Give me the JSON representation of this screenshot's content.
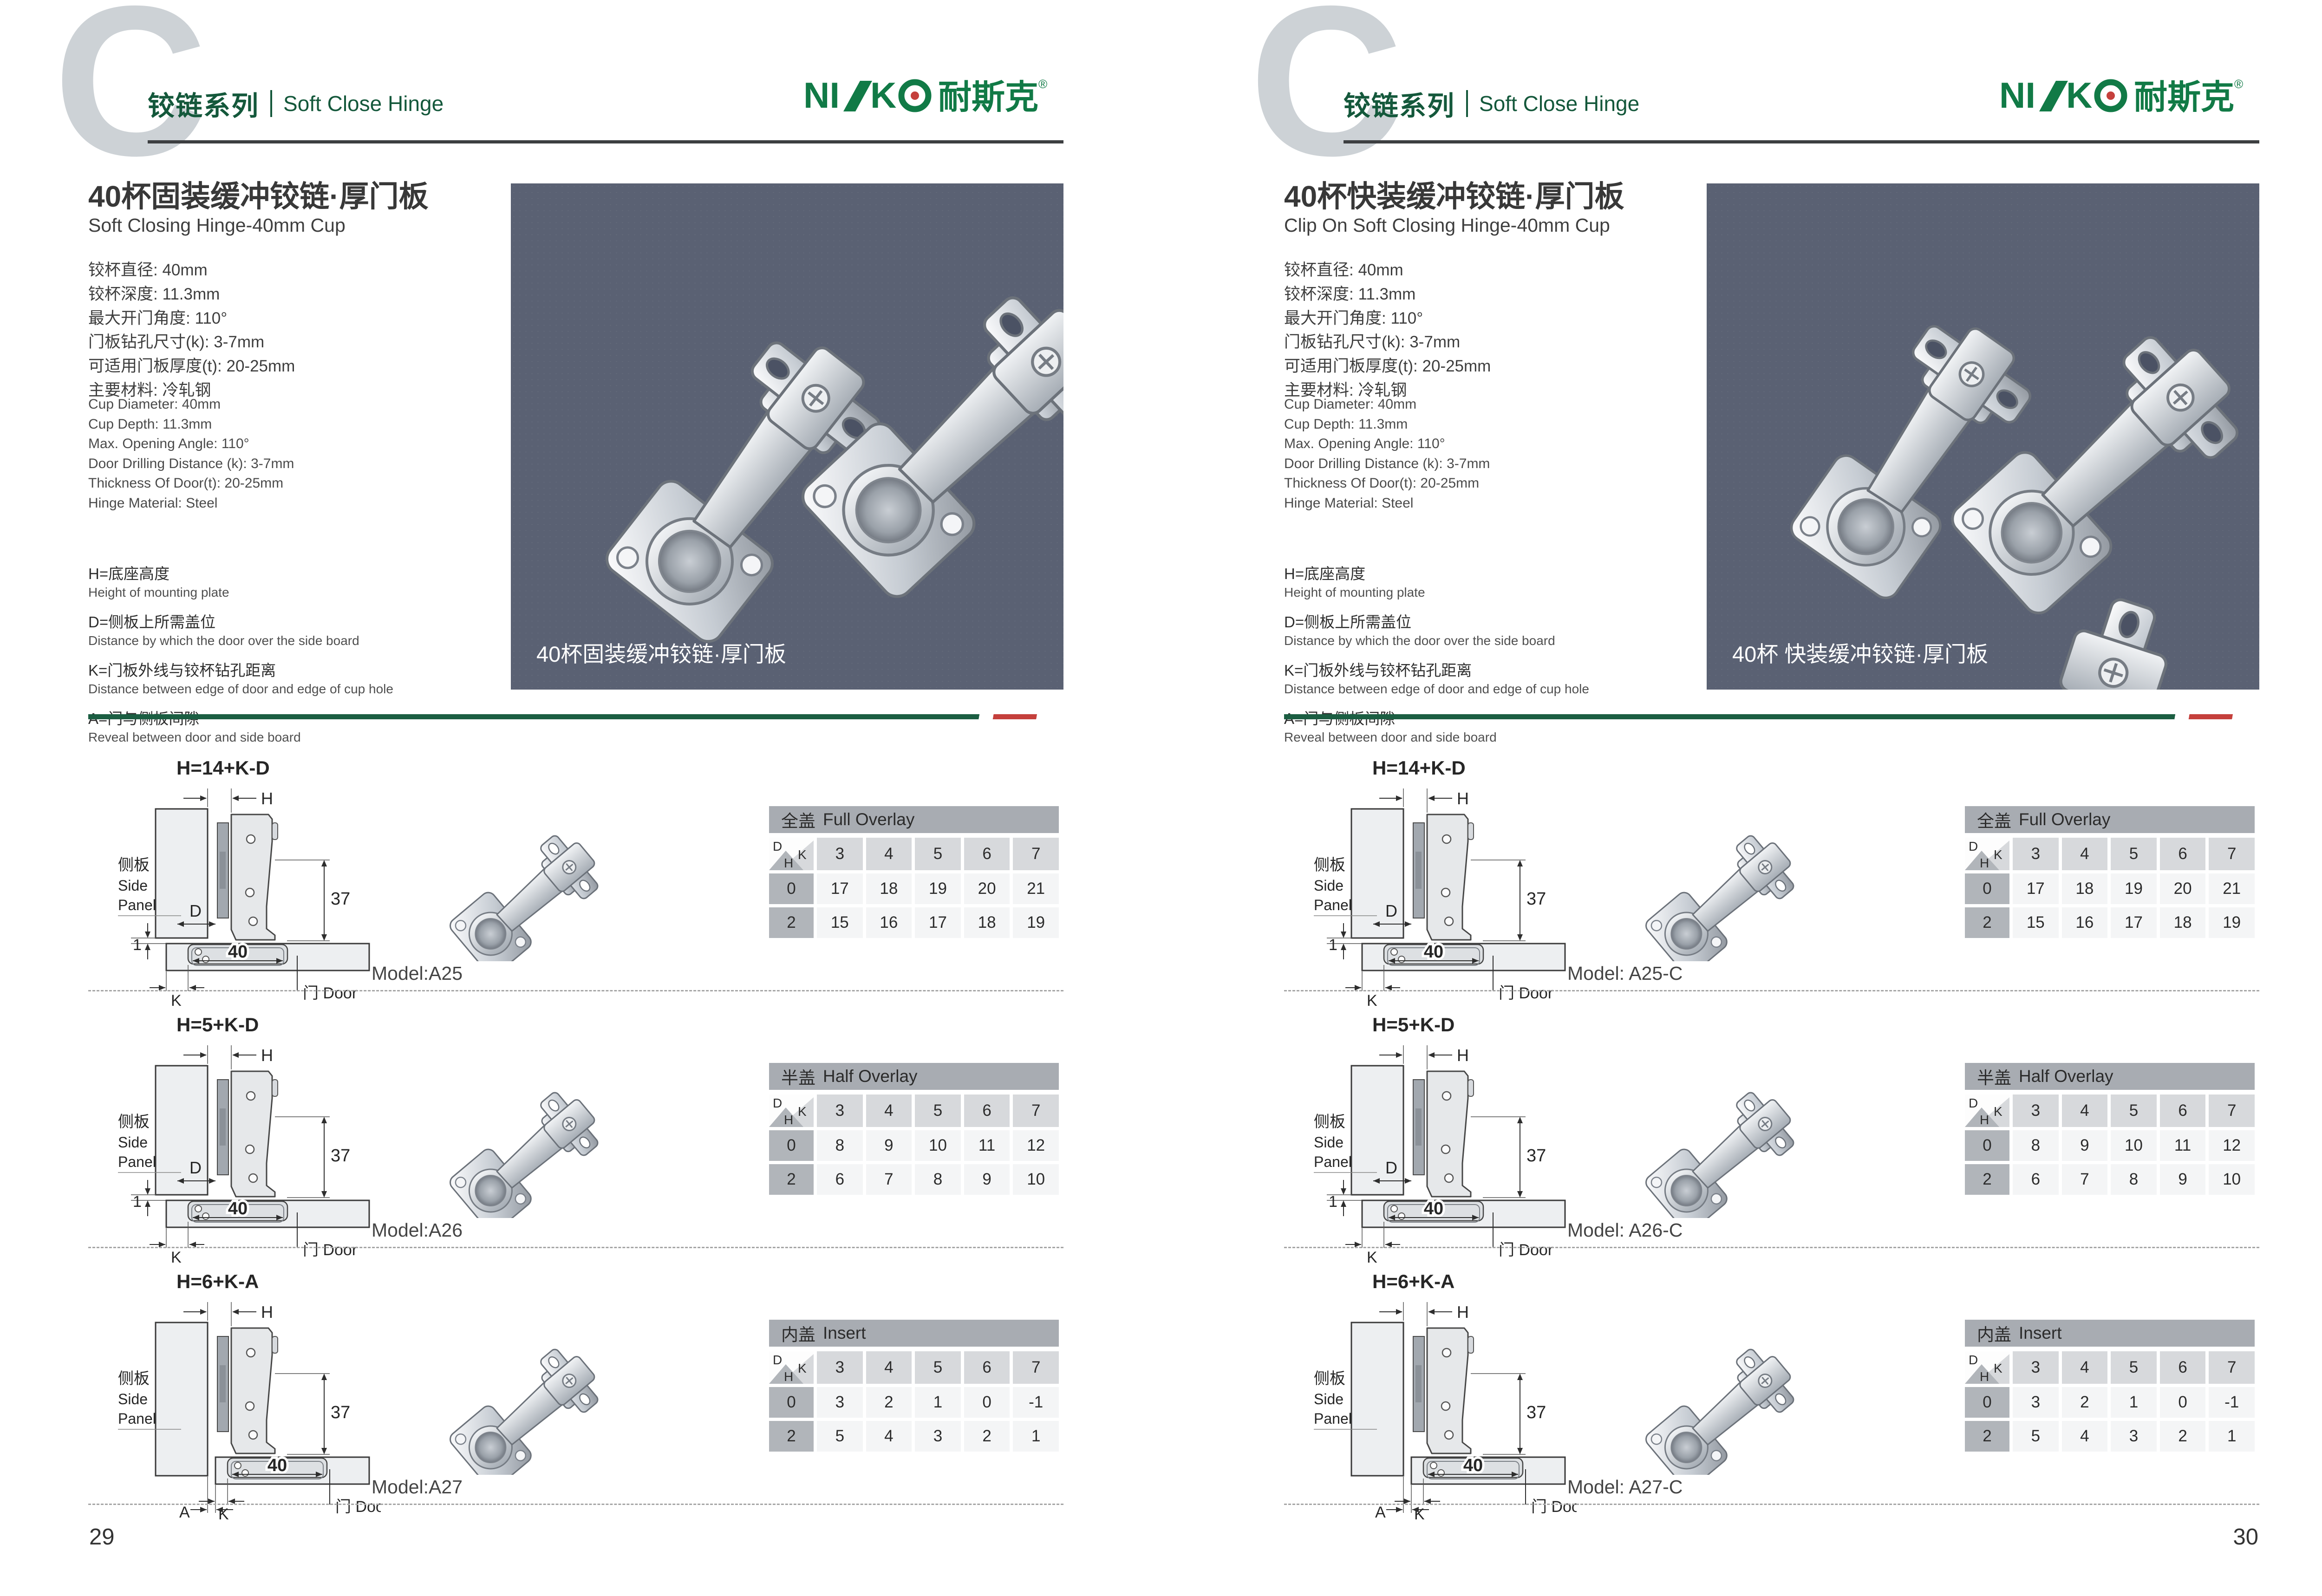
{
  "colors": {
    "divider_green": "#1b5e42",
    "divider_red": "#c5403c",
    "logo_green": "#117a46",
    "header_green": "#14583b",
    "photo_bg": "#5a6173"
  },
  "brand": {
    "latin_ni": "NI",
    "latin_k": "K",
    "cn": "耐斯克",
    "reg": "®"
  },
  "diagram_labels": {
    "side_panel_cn": "侧板",
    "side_panel_en1": "Side",
    "side_panel_en2": "Panel",
    "door": "门 Door",
    "h": "H",
    "d": "D",
    "k": "K",
    "a": "A",
    "dim_37": "37",
    "dim_40": "40",
    "dim_1": "1"
  },
  "pages": [
    {
      "page_number": "29",
      "header": {
        "watermark": "C",
        "series_cn": "铰链系列",
        "series_en": "Soft Close Hinge"
      },
      "title_cn": "40杯固装缓冲铰链·厚门板",
      "title_en": "Soft Closing Hinge-40mm Cup",
      "specs_cn": [
        "铰杯直径: 40mm",
        "铰杯深度: 11.3mm",
        "最大开门角度: 110°",
        "门板钻孔尺寸(k): 3-7mm",
        "可适用门板厚度(t): 20-25mm",
        "主要材料: 冷轧钢"
      ],
      "specs_en": [
        "Cup Diameter: 40mm",
        "Cup Depth: 11.3mm",
        "Max. Opening Angle: 110°",
        "Door Drilling Distance (k): 3-7mm",
        "Thickness Of Door(t): 20-25mm",
        "Hinge Material: Steel"
      ],
      "legend": [
        {
          "cn": "H=底座高度",
          "en": "Height of mounting plate"
        },
        {
          "cn": "D=侧板上所需盖位",
          "en": "Distance by which the door over the side board"
        },
        {
          "cn": "K=门板外线与铰杯钻孔距离",
          "en": "Distance between edge of door and edge of cup hole"
        },
        {
          "cn": "A=门与侧板间隙",
          "en": "Reveal between door and side board"
        }
      ],
      "photo": {
        "caption": "40杯固装缓冲铰链·厚门板",
        "variant": "pair"
      },
      "rows": [
        {
          "formula": "H=14+K-D",
          "diagram_type": "overlay",
          "model": "Model:A25",
          "table": {
            "title_cn": "全盖",
            "title_en": "Full Overlay",
            "corner": {
              "d": "D",
              "k": "K",
              "h": "H"
            },
            "columns": [
              "3",
              "4",
              "5",
              "6",
              "7"
            ],
            "rows": [
              {
                "h": "0",
                "values": [
                  "17",
                  "18",
                  "19",
                  "20",
                  "21"
                ]
              },
              {
                "h": "2",
                "values": [
                  "15",
                  "16",
                  "17",
                  "18",
                  "19"
                ]
              }
            ]
          }
        },
        {
          "formula": "H=5+K-D",
          "diagram_type": "overlay",
          "model": "Model:A26",
          "table": {
            "title_cn": "半盖",
            "title_en": "Half Overlay",
            "corner": {
              "d": "D",
              "k": "K",
              "h": "H"
            },
            "columns": [
              "3",
              "4",
              "5",
              "6",
              "7"
            ],
            "rows": [
              {
                "h": "0",
                "values": [
                  "8",
                  "9",
                  "10",
                  "11",
                  "12"
                ]
              },
              {
                "h": "2",
                "values": [
                  "6",
                  "7",
                  "8",
                  "9",
                  "10"
                ]
              }
            ]
          }
        },
        {
          "formula": "H=6+K-A",
          "diagram_type": "insert",
          "model": "Model:A27",
          "table": {
            "title_cn": "内盖",
            "title_en": "Insert",
            "corner": {
              "d": "D",
              "k": "K",
              "h": "H"
            },
            "columns": [
              "3",
              "4",
              "5",
              "6",
              "7"
            ],
            "rows": [
              {
                "h": "0",
                "values": [
                  "3",
                  "2",
                  "1",
                  "0",
                  "-1"
                ]
              },
              {
                "h": "2",
                "values": [
                  "5",
                  "4",
                  "3",
                  "2",
                  "1"
                ]
              }
            ]
          }
        }
      ]
    },
    {
      "page_number": "30",
      "header": {
        "watermark": "C",
        "series_cn": "铰链系列",
        "series_en": "Soft Close Hinge"
      },
      "title_cn": "40杯快装缓冲铰链·厚门板",
      "title_en": "Clip On Soft Closing Hinge-40mm Cup",
      "specs_cn": [
        "铰杯直径: 40mm",
        "铰杯深度: 11.3mm",
        "最大开门角度: 110°",
        "门板钻孔尺寸(k): 3-7mm",
        "可适用门板厚度(t): 20-25mm",
        "主要材料: 冷轧钢"
      ],
      "specs_en": [
        "Cup Diameter: 40mm",
        "Cup Depth: 11.3mm",
        "Max. Opening Angle: 110°",
        "Door Drilling Distance (k): 3-7mm",
        "Thickness Of Door(t): 20-25mm",
        "Hinge Material: Steel"
      ],
      "legend": [
        {
          "cn": "H=底座高度",
          "en": "Height of mounting plate"
        },
        {
          "cn": "D=侧板上所需盖位",
          "en": "Distance by which the door over the side board"
        },
        {
          "cn": "K=门板外线与铰杯钻孔距离",
          "en": "Distance between edge of door and edge of cup hole"
        },
        {
          "cn": "A=门与侧板间隙",
          "en": "Reveal between door and side board"
        }
      ],
      "photo": {
        "caption": "40杯 快装缓冲铰链·厚门板",
        "variant": "triple"
      },
      "rows": [
        {
          "formula": "H=14+K-D",
          "diagram_type": "overlay",
          "model": "Model: A25-C",
          "table": {
            "title_cn": "全盖",
            "title_en": "Full Overlay",
            "corner": {
              "d": "D",
              "k": "K",
              "h": "H"
            },
            "columns": [
              "3",
              "4",
              "5",
              "6",
              "7"
            ],
            "rows": [
              {
                "h": "0",
                "values": [
                  "17",
                  "18",
                  "19",
                  "20",
                  "21"
                ]
              },
              {
                "h": "2",
                "values": [
                  "15",
                  "16",
                  "17",
                  "18",
                  "19"
                ]
              }
            ]
          }
        },
        {
          "formula": "H=5+K-D",
          "diagram_type": "overlay",
          "model": "Model: A26-C",
          "table": {
            "title_cn": "半盖",
            "title_en": "Half Overlay",
            "corner": {
              "d": "D",
              "k": "K",
              "h": "H"
            },
            "columns": [
              "3",
              "4",
              "5",
              "6",
              "7"
            ],
            "rows": [
              {
                "h": "0",
                "values": [
                  "8",
                  "9",
                  "10",
                  "11",
                  "12"
                ]
              },
              {
                "h": "2",
                "values": [
                  "6",
                  "7",
                  "8",
                  "9",
                  "10"
                ]
              }
            ]
          }
        },
        {
          "formula": "H=6+K-A",
          "diagram_type": "insert",
          "model": "Model: A27-C",
          "table": {
            "title_cn": "内盖",
            "title_en": "Insert",
            "corner": {
              "d": "D",
              "k": "K",
              "h": "H"
            },
            "columns": [
              "3",
              "4",
              "5",
              "6",
              "7"
            ],
            "rows": [
              {
                "h": "0",
                "values": [
                  "3",
                  "2",
                  "1",
                  "0",
                  "-1"
                ]
              },
              {
                "h": "2",
                "values": [
                  "5",
                  "4",
                  "3",
                  "2",
                  "1"
                ]
              }
            ]
          }
        }
      ]
    }
  ]
}
